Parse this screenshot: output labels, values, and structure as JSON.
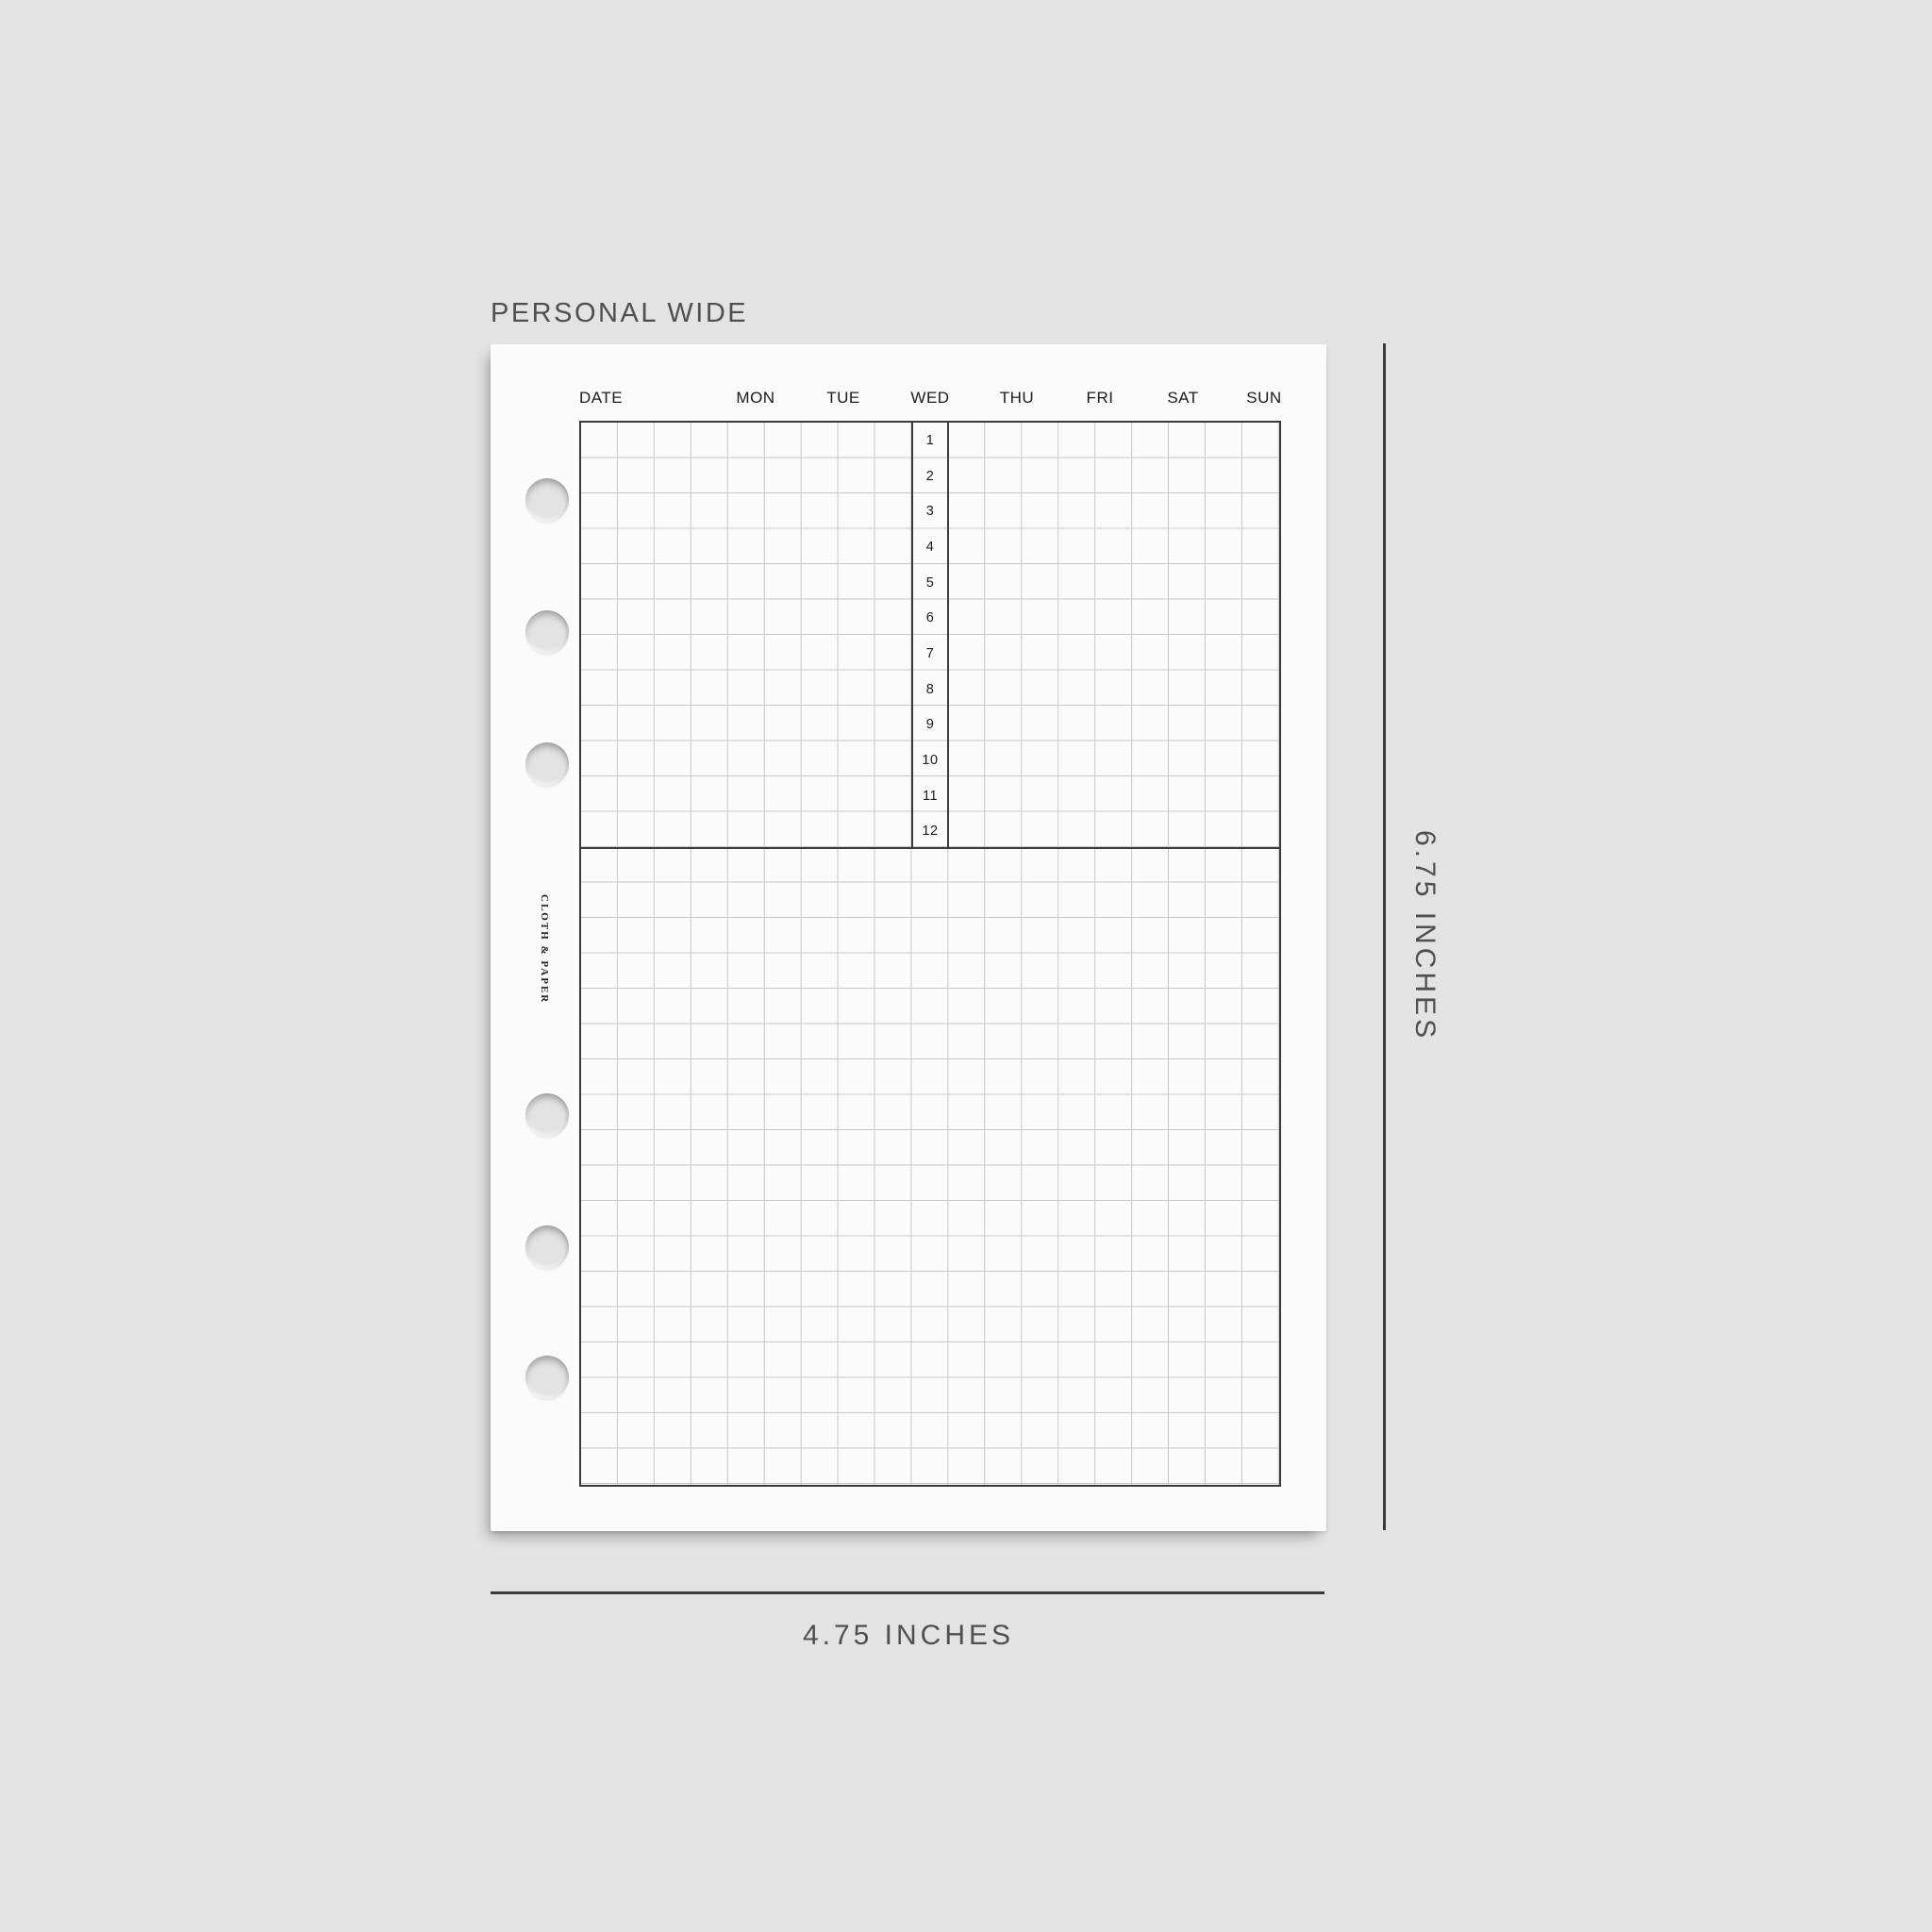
{
  "title": "PERSONAL WIDE",
  "page": {
    "brand_text": "CLOTH & PAPER",
    "header": {
      "date_label": "DATE",
      "day_labels": [
        "MON",
        "TUE",
        "WED",
        "THU",
        "FRI",
        "SAT",
        "SUN"
      ]
    },
    "time_column": {
      "slots": [
        "1",
        "2",
        "3",
        "4",
        "5",
        "6",
        "7",
        "8",
        "9",
        "10",
        "11",
        "12"
      ]
    },
    "holes_count": 6
  },
  "dimension_annotations": {
    "height_label": "6.75 INCHES",
    "width_label": "4.75 INCHES"
  },
  "colors": {
    "background": "#e3e3e3",
    "paper": "#fbfbfb",
    "grid_line_light": "#c7c7c7",
    "grid_line_dark": "#3a3a3a",
    "text_dark": "#1b1b1b",
    "text_gray": "#4f4f4f"
  }
}
